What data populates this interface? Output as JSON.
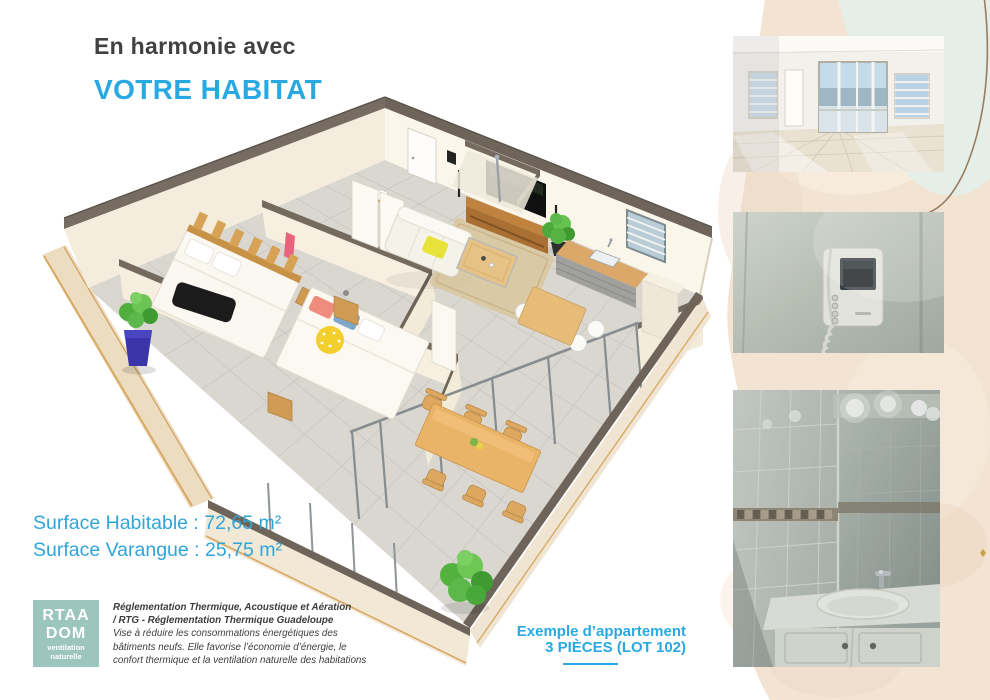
{
  "header": {
    "line1": "En harmonie avec",
    "line2": "VOTRE HABITAT"
  },
  "surfaces": {
    "habitable": "Surface Habitable : 72,65 m²",
    "varangue": "Surface Varangue : 25,75 m²"
  },
  "logo": {
    "line1": "RTAA",
    "line2": "DOM",
    "line3": "ventilation",
    "line4": "naturelle",
    "bg": "#9cc6bd"
  },
  "legal": {
    "lines": [
      "Réglementation Thermique, Acoustique et Aération",
      "/ RTG - Réglementation Thermique Guadeloupe",
      "Vise à réduire les consommations énergétiques des",
      "bâtiments neufs. Elle favorise l’économie d’énergie, le",
      "confort thermique et la ventilation naturelle des habitations"
    ]
  },
  "example": {
    "line1": "Exemple d’appartement",
    "line2": "3 PIÈCES (LOT 102)"
  },
  "photos": {
    "top": "apartment-interior",
    "middle": "video-intercom",
    "bottom": "bathroom-vanity"
  },
  "colors": {
    "accent": "#29a9e1",
    "logo_teal": "#9cc6bd",
    "wall_top": "#6e6459",
    "wall_face": "#f7f0e1",
    "floor": "#d9d6d0",
    "wood": "#dca86a",
    "band_beige": "#f2e3d3",
    "mint_wash": "#e6efe7"
  }
}
